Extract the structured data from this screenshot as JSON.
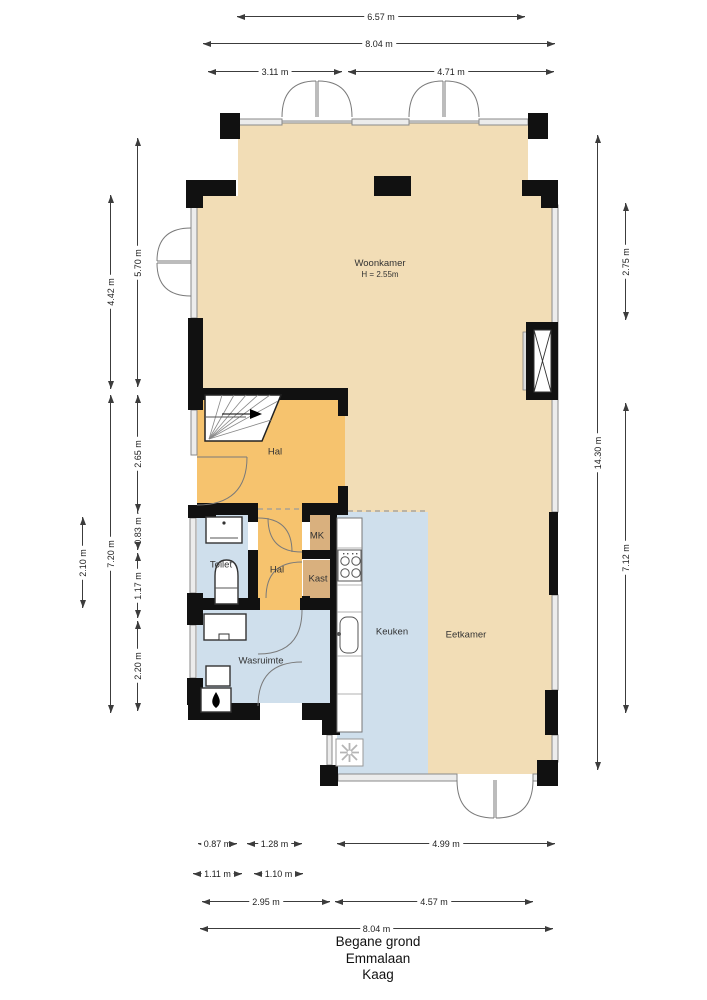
{
  "palette": {
    "beige": "#f2ddb6",
    "orange": "#f6c36e",
    "blue": "#cfdfec",
    "tan": "#d9b07e",
    "wall": "#111111"
  },
  "title": {
    "floor": "Begane grond",
    "street": "Emmalaan",
    "city": "Kaag"
  },
  "rooms": [
    {
      "id": "woonkamer",
      "label": "Woonkamer",
      "sub": "H = 2.55m",
      "x": 380,
      "y": 269
    },
    {
      "id": "hal",
      "label": "Hal",
      "x": 275,
      "y": 452
    },
    {
      "id": "toilet",
      "label": "Toilet",
      "x": 221,
      "y": 565
    },
    {
      "id": "hal-2",
      "label": "Hal",
      "x": 277,
      "y": 570
    },
    {
      "id": "mk",
      "label": "MK",
      "x": 317,
      "y": 536
    },
    {
      "id": "kast",
      "label": "Kast",
      "x": 318,
      "y": 579
    },
    {
      "id": "wasruimte",
      "label": "Wasruimte",
      "x": 261,
      "y": 661
    },
    {
      "id": "keuken",
      "label": "Keuken",
      "x": 392,
      "y": 632
    },
    {
      "id": "eetkamer",
      "label": "Eetkamer",
      "x": 466,
      "y": 635
    }
  ],
  "dimensions": {
    "horizontal": [
      {
        "label": "6.57 m",
        "x": 237,
        "y": 16,
        "len": 288
      },
      {
        "label": "8.04 m",
        "x": 203,
        "y": 43,
        "len": 352
      },
      {
        "label": "3.11 m",
        "x": 208,
        "y": 71,
        "len": 134
      },
      {
        "label": "4.71 m",
        "x": 348,
        "y": 71,
        "len": 206
      },
      {
        "label": "0.87 m",
        "x": 198,
        "y": 843,
        "len": 39
      },
      {
        "label": "1.28 m",
        "x": 247,
        "y": 843,
        "len": 55
      },
      {
        "label": "4.99 m",
        "x": 337,
        "y": 843,
        "len": 218
      },
      {
        "label": "1.11 m",
        "x": 193,
        "y": 873,
        "len": 49
      },
      {
        "label": "1.10 m",
        "x": 254,
        "y": 873,
        "len": 49
      },
      {
        "label": "2.95 m",
        "x": 202,
        "y": 901,
        "len": 128
      },
      {
        "label": "4.57 m",
        "x": 335,
        "y": 901,
        "len": 198
      },
      {
        "label": "8.04 m",
        "x": 200,
        "y": 928,
        "len": 353
      }
    ],
    "vertical": [
      {
        "label": "5.70 m",
        "x": 137,
        "y": 138,
        "len": 249
      },
      {
        "label": "4.42 m",
        "x": 110,
        "y": 195,
        "len": 194
      },
      {
        "label": "2.65 m",
        "x": 137,
        "y": 395,
        "len": 117
      },
      {
        "label": "7.20 m",
        "x": 110,
        "y": 395,
        "len": 318
      },
      {
        "label": "0.83 m",
        "x": 137,
        "y": 512,
        "len": 38
      },
      {
        "label": "2.10 m",
        "x": 82,
        "y": 517,
        "len": 91
      },
      {
        "label": "1.17 m",
        "x": 137,
        "y": 553,
        "len": 65
      },
      {
        "label": "2.20 m",
        "x": 137,
        "y": 621,
        "len": 90
      },
      {
        "label": "14.30 m",
        "x": 597,
        "y": 135,
        "len": 635
      },
      {
        "label": "2.75 m",
        "x": 625,
        "y": 203,
        "len": 117
      },
      {
        "label": "7.12 m",
        "x": 625,
        "y": 403,
        "len": 310
      }
    ]
  }
}
